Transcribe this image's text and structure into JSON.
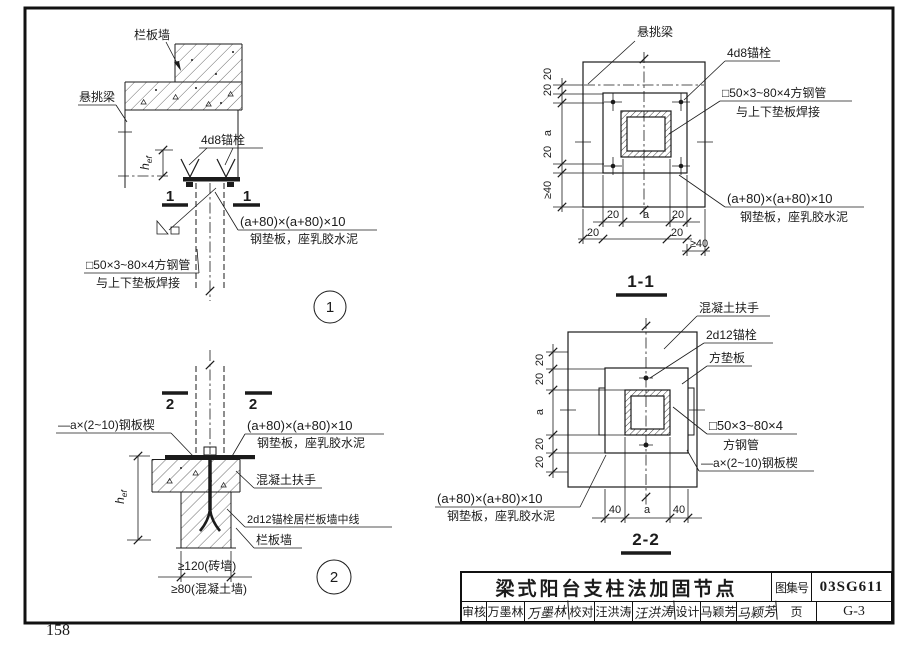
{
  "sheet_number": "158",
  "details": {
    "d1": {
      "bubble": "1",
      "section_digit": "1",
      "labels": {
        "parapet_wall": "栏板墙",
        "cantilever_beam": "悬挑梁",
        "anchor": "4d8锚栓",
        "plate_line1": "(a+80)×(a+80)×10",
        "plate_line2": "钢垫板，座乳胶水泥",
        "tube_line1": "□50×3~80×4方钢管",
        "tube_line2": "与上下垫板焊接"
      },
      "dims": {
        "hef_main": "h",
        "hef_sub": "ef"
      }
    },
    "p11": {
      "title": "1-1",
      "labels": {
        "cantilever_beam": "悬挑梁",
        "anchor": "4d8锚栓",
        "tube_line1": "□50×3~80×4方钢管",
        "tube_line2": "与上下垫板焊接",
        "plate_line1": "(a+80)×(a+80)×10",
        "plate_line2": "钢垫板，座乳胶水泥"
      },
      "dims": {
        "left": [
          "20",
          "20",
          "a",
          "20",
          "≥40"
        ],
        "bottom_row1": [
          "20",
          "a",
          "20"
        ],
        "bottom_row2": [
          "20",
          "20"
        ],
        "bottom_row3": "≥40"
      }
    },
    "d2": {
      "bubble": "2",
      "section_digit": "2",
      "labels": {
        "wedge": "—a×(2~10)钢板楔",
        "plate_line1": "(a+80)×(a+80)×10",
        "plate_line2": "钢垫板，座乳胶水泥",
        "handrail": "混凝土扶手",
        "anchor": "2d12锚栓居栏板墙中线",
        "parapet_wall": "栏板墙",
        "dim_brick": "≥120(砖墙)",
        "dim_concrete": "≥80(混凝土墙)"
      },
      "dims": {
        "hef_main": "h",
        "hef_sub": "ef"
      }
    },
    "p22": {
      "title": "2-2",
      "labels": {
        "handrail": "混凝土扶手",
        "anchor": "2d12锚栓",
        "pad": "方垫板",
        "tube_line1": "□50×3~80×4",
        "tube_line2": "方钢管",
        "wedge": "—a×(2~10)钢板楔",
        "plate_line1": "(a+80)×(a+80)×10",
        "plate_line2": "钢垫板，座乳胶水泥"
      },
      "dims": {
        "left": [
          "20",
          "20",
          "a",
          "20",
          "20"
        ],
        "bottom": [
          "40",
          "a",
          "40"
        ]
      }
    }
  },
  "title_block": {
    "title": "梁式阳台支柱法加固节点",
    "atlas_label": "图集号",
    "atlas_number": "03SG611",
    "page_label": "页",
    "page_number": "G-3",
    "staff": [
      {
        "role": "审核",
        "name": "万墨林",
        "signature": "万墨林"
      },
      {
        "role": "校对",
        "name": "汪洪涛",
        "signature": "汪洪涛"
      },
      {
        "role": "设计",
        "name": "马颖芳",
        "signature": "马颖芳"
      }
    ]
  }
}
